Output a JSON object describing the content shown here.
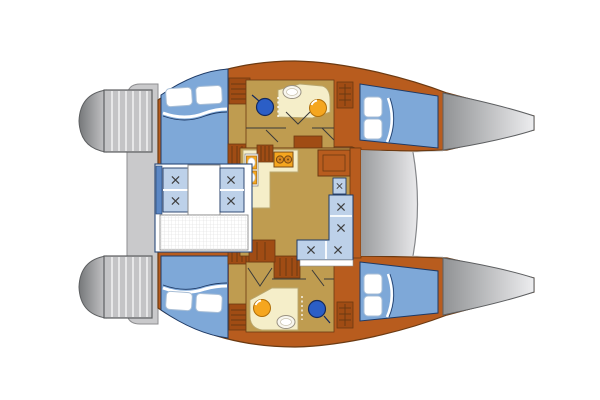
{
  "diagram": {
    "type": "catamaran-floor-plan",
    "view": "top-down interior layout, bows to the right, transom steps to the left",
    "features": [
      "transom-steps-port",
      "transom-steps-starboard",
      "aft-walkway",
      "aft-cabin-port-double-berth",
      "aft-cabin-starboard-double-berth",
      "forward-cabin-port-berth",
      "forward-cabin-starboard-berth",
      "bathroom-port",
      "bathroom-starboard",
      "toilet-icon",
      "washbasin-oval-icon",
      "washbasin-round-icon",
      "galley-stove-icon",
      "galley-double-sink-icon",
      "saloon-l-settee",
      "cockpit-bench-seats",
      "cockpit-table",
      "cockpit-sunpad-grid",
      "companionway-steps",
      "foredeck",
      "trampoline",
      "bow-port",
      "bow-starboard"
    ]
  },
  "colors": {
    "bg": "#ffffff",
    "wood": "#b85c1e",
    "wood_dark": "#a04c14",
    "wood_stroke": "#6b3a12",
    "floor_tan": "#bf9c50",
    "cream": "#f5eec9",
    "cream_stroke": "#b9a76f",
    "cabin_blue": "#7ea8d8",
    "cushion_blue": "#bdd1e9",
    "steel_blue": "#5b87c5",
    "navy": "#1e3a66",
    "toilet_blue": "#2b5ec6",
    "toilet_stroke": "#14295c",
    "basin_orange": "#f5a61f",
    "orange_stroke": "#b06e08",
    "burner_ring": "#7a4a12",
    "platform_gray": "#c4c4c6",
    "walkway_gray": "#c9c9cb",
    "gray_stroke": "#8e8e90",
    "bow_dark": "#909294",
    "bow_light": "#ededef",
    "fore_dark": "#9a9c9e",
    "fore_light": "#e9e9eb",
    "cap_dark": "#76787a",
    "cap_light": "#c6c6c8",
    "outline_gray": "#5d5f61",
    "grid_line": "#dcdcdc",
    "white": "#ffffff",
    "pillow_stroke": "#a8bed6",
    "xmark": "#3f3f3f",
    "door_line": "#3a3a3a",
    "table_stroke": "#8a8a8a"
  }
}
